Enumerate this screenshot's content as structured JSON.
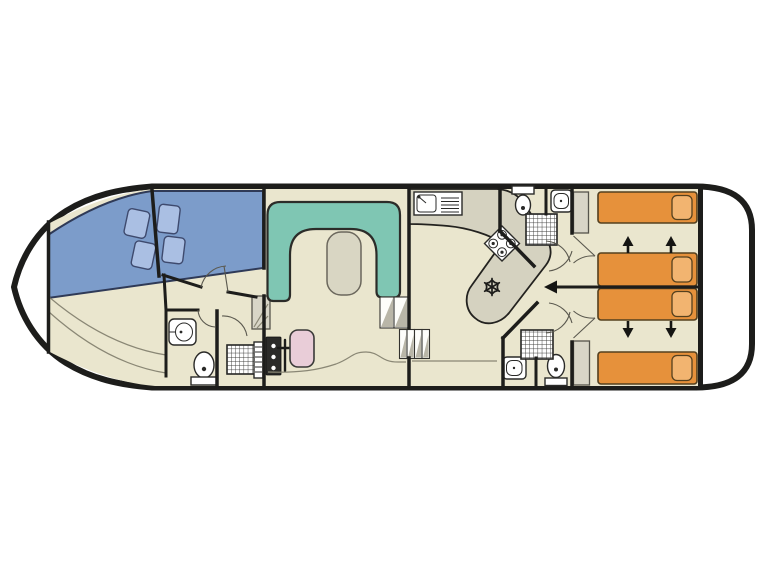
{
  "diagram": {
    "type": "houseboat-floor-plan",
    "orientation": "bow-left-stern-right",
    "background": "#ffffff"
  },
  "colors": {
    "hull": "#1d1d1b",
    "wall": "#1d1d1b",
    "deck": "#ffffff",
    "floor": "#eae6ce",
    "bowBed": "#7c9cca",
    "bowPillow": "#aabfe3",
    "sofa": "#7fc6b3",
    "table": "#d9d6c3",
    "counter": "#d5d2c0",
    "sternBed": "#e6913b",
    "sternPillow": "#f2b470",
    "helmSeat": "#e9cdd8",
    "wardrobe": "#d8d5c7",
    "fixture": "#ffffff",
    "fixtureOutline": "#2a2a28",
    "stepShade": "#b9b6a8",
    "thinLine": "#8a8775",
    "arrow": "#151513"
  },
  "rooms": [
    {
      "id": "bow-deck",
      "label": "bow deck"
    },
    {
      "id": "bow-cabin",
      "label": "bow cabin",
      "furniture": [
        "angled double berth in two sections",
        "4 pillows"
      ]
    },
    {
      "id": "bow-bathroom",
      "label": "bow bathroom",
      "fixtures": [
        "washbasin",
        "toilet"
      ]
    },
    {
      "id": "bow-shower-room",
      "label": "shower room",
      "fixtures": [
        "shower",
        "grille",
        "wardrobe"
      ]
    },
    {
      "id": "saloon",
      "label": "saloon",
      "furniture": [
        "U-shaped sofa",
        "table",
        "helm seat",
        "helm console",
        "steering wheel",
        "steps"
      ]
    },
    {
      "id": "galley",
      "label": "galley",
      "fixtures": [
        "sink with drainer",
        "4-burner hob",
        "refrigerator",
        "steps"
      ]
    },
    {
      "id": "aft-bathroom-top",
      "label": "aft bathroom (top)",
      "fixtures": [
        "toilet",
        "washbasin",
        "shower"
      ]
    },
    {
      "id": "aft-bathroom-bottom",
      "label": "aft bathroom (bottom)",
      "fixtures": [
        "washbasin",
        "toilet",
        "shower"
      ]
    },
    {
      "id": "aft-cabin-top",
      "label": "aft cabin (top)",
      "furniture": [
        "2 single beds",
        "wardrobe"
      ],
      "feature": "beds slide together (up arrows)"
    },
    {
      "id": "aft-cabin-bottom",
      "label": "aft cabin (bottom)",
      "furniture": [
        "2 single beds",
        "wardrobe"
      ],
      "feature": "beds slide together (down arrows)"
    },
    {
      "id": "stern-deck",
      "label": "stern deck"
    }
  ],
  "counts": {
    "single_beds_aft": 4,
    "bow_pillows": 4,
    "toilets": 3,
    "washbasins": 3,
    "showers": 3,
    "wardrobes": 3,
    "stair_flights": 2
  }
}
